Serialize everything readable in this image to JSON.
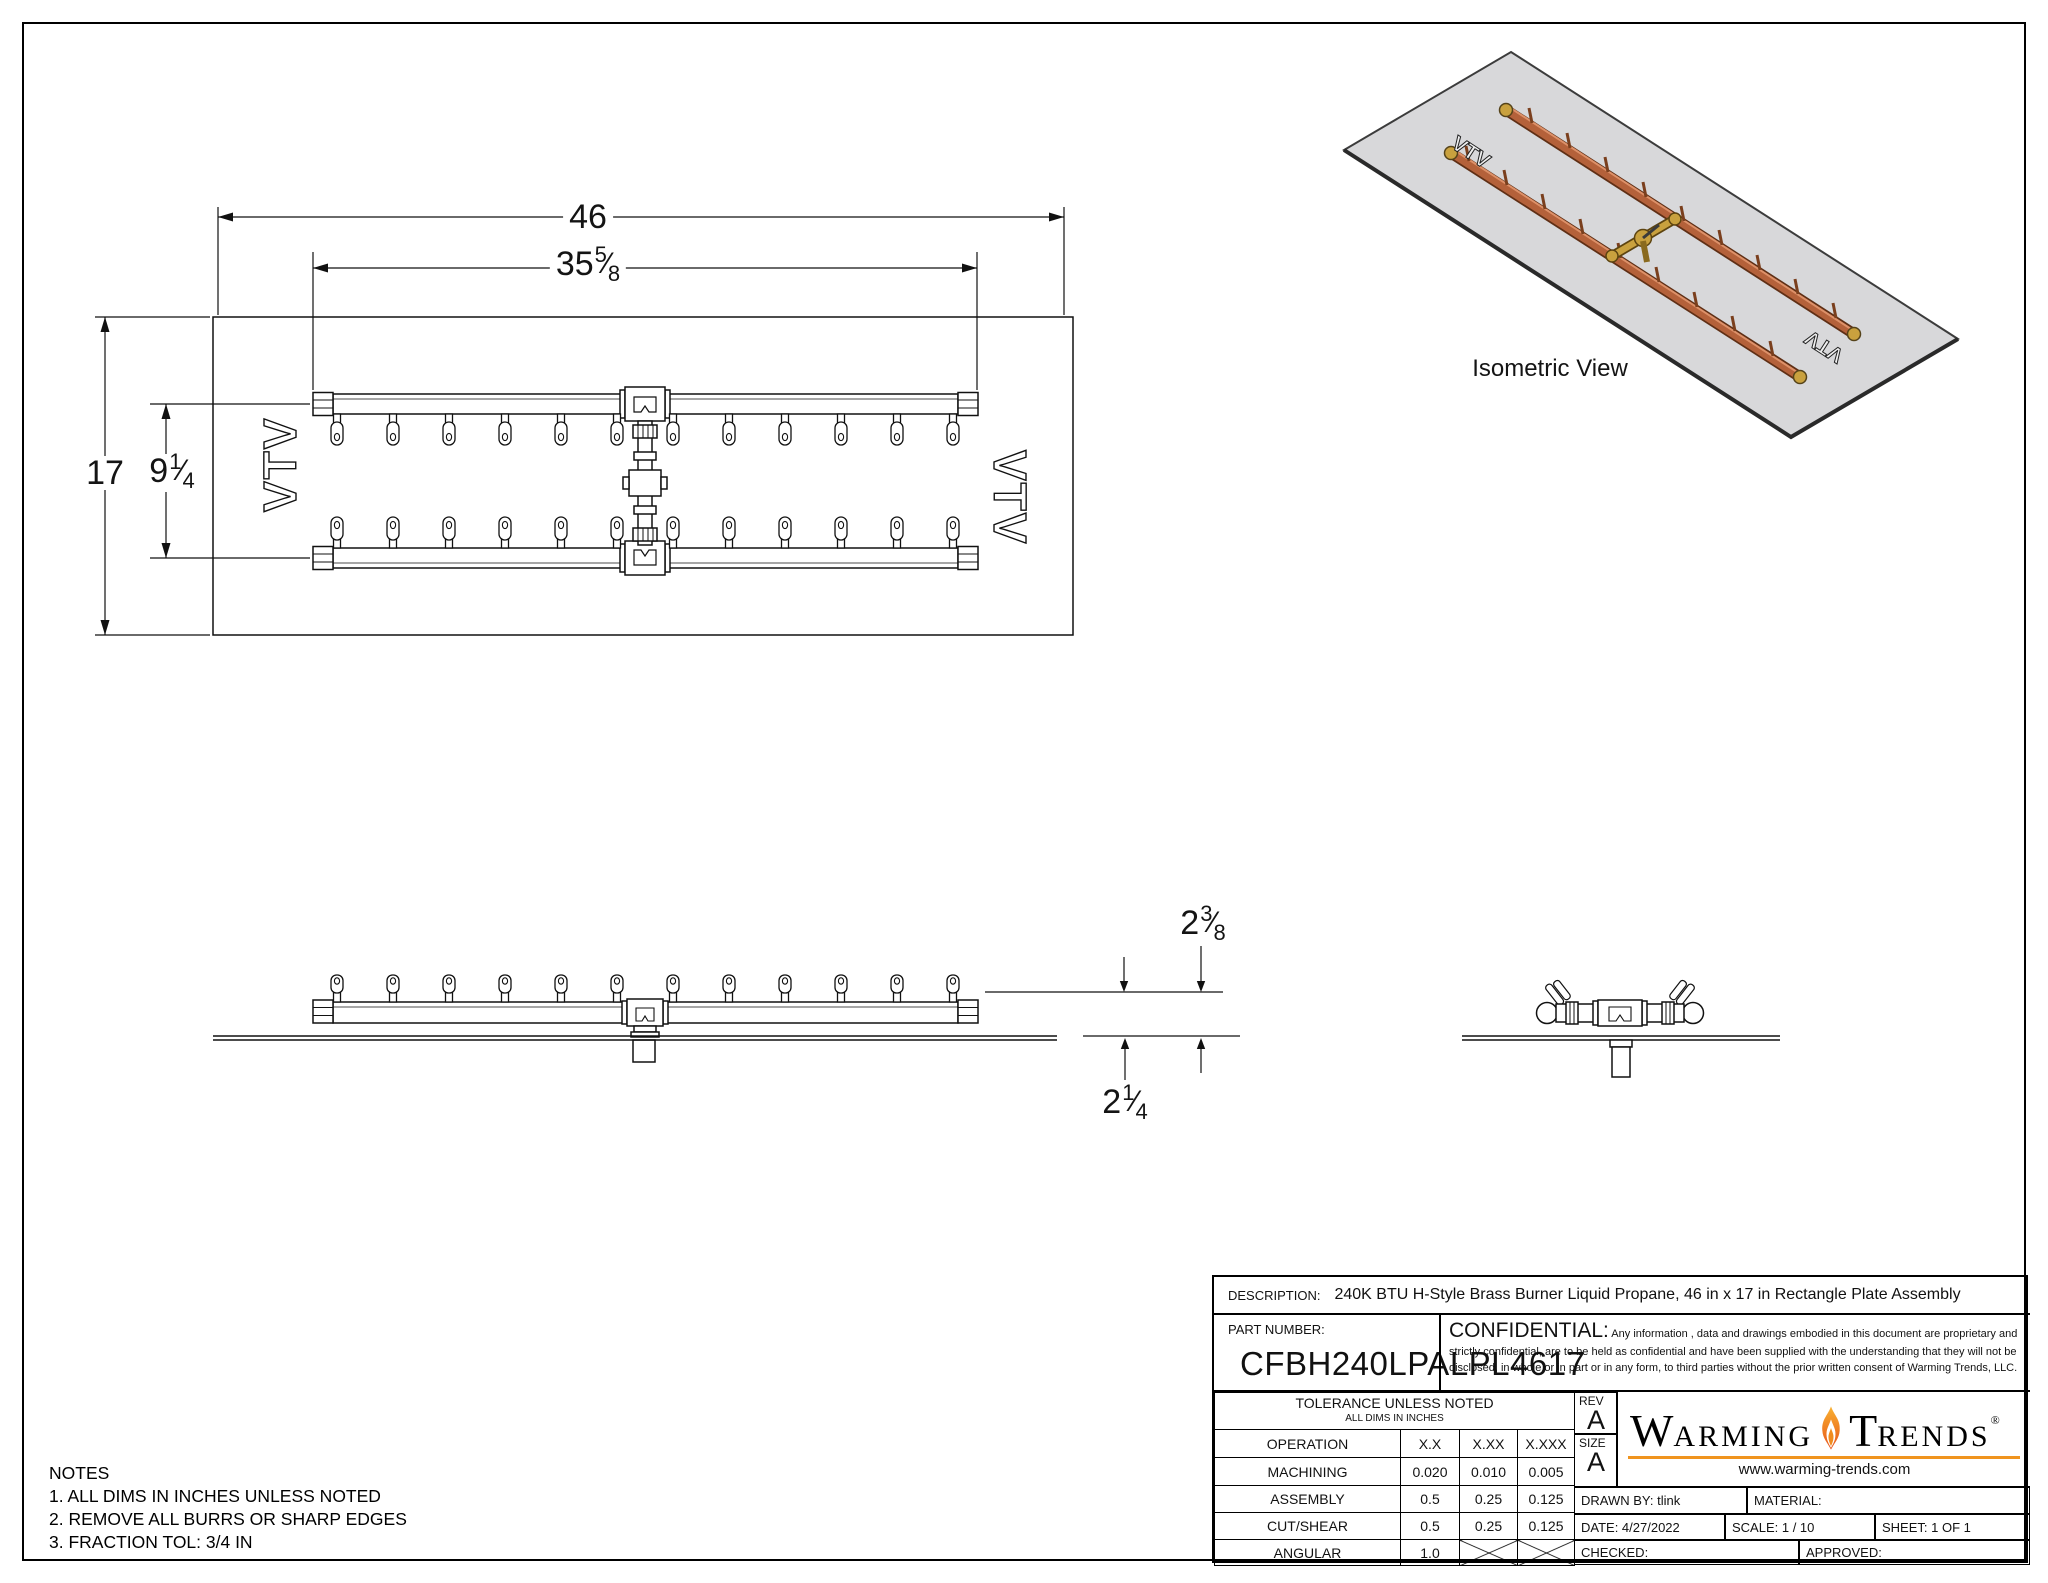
{
  "dims": {
    "plate_width": "46",
    "burner_width": {
      "whole": "35",
      "num": "5",
      "den": "8"
    },
    "plate_height": "17",
    "burner_height": {
      "whole": "9",
      "num": "1",
      "den": "4"
    },
    "height_above_plate": {
      "whole": "2",
      "num": "3",
      "den": "8"
    },
    "depth_below_plate": {
      "whole": "2",
      "num": "1",
      "den": "4"
    },
    "frac_slash": "⁄"
  },
  "marks": {
    "vtv": "VTV"
  },
  "iso": {
    "label": "Isometric View"
  },
  "notes": {
    "title": "NOTES",
    "line1": "1. ALL DIMS IN INCHES UNLESS NOTED",
    "line2": "2. REMOVE ALL BURRS OR SHARP EDGES",
    "line3": "3. FRACTION TOL: 3/4 IN"
  },
  "title_block": {
    "description_label": "DESCRIPTION:",
    "description": "240K BTU H-Style Brass Burner Liquid Propane, 46 in x 17 in Rectangle Plate Assembly",
    "part_number_label": "PART NUMBER:",
    "part_number": "CFBH240LPALPL4617",
    "confidential_label": "CONFIDENTIAL:",
    "confidential_text": " Any information , data and drawings embodied in this document are proprietary and strictly confidential, are to be held as confidential and have been supplied with the understanding that they will not be disclosed, in whole or in part or in any form, to third parties without the prior written consent of Warming Trends, LLC.",
    "tolerance": {
      "header": "TOLERANCE UNLESS NOTED",
      "subheader": "ALL DIMS IN INCHES",
      "columns": [
        "OPERATION",
        "X.X",
        "X.XX",
        "X.XXX"
      ],
      "rows": [
        [
          "MACHINING",
          "0.020",
          "0.010",
          "0.005"
        ],
        [
          "ASSEMBLY",
          "0.5",
          "0.25",
          "0.125"
        ],
        [
          "CUT/SHEAR",
          "0.5",
          "0.25",
          "0.125"
        ],
        [
          "ANGULAR",
          "1.0",
          "",
          ""
        ]
      ]
    },
    "rev_label": "REV",
    "rev": "A",
    "size_label": "SIZE",
    "size": "A",
    "logo": {
      "w1_initial": "W",
      "w1_rest": "ARMING",
      "w2_initial": "T",
      "w2_rest": "RENDS",
      "reg": "®",
      "url": "www.warming-trends.com",
      "rule_color": "#f0941e"
    },
    "drawn_by": "DRAWN BY: tlink",
    "material_label": "MATERIAL:",
    "date": "DATE:  4/27/2022",
    "scale": "SCALE:  1 / 10",
    "sheet": "SHEET:  1   OF   1",
    "checked_label": "CHECKED:",
    "approved_label": "APPROVED:"
  }
}
